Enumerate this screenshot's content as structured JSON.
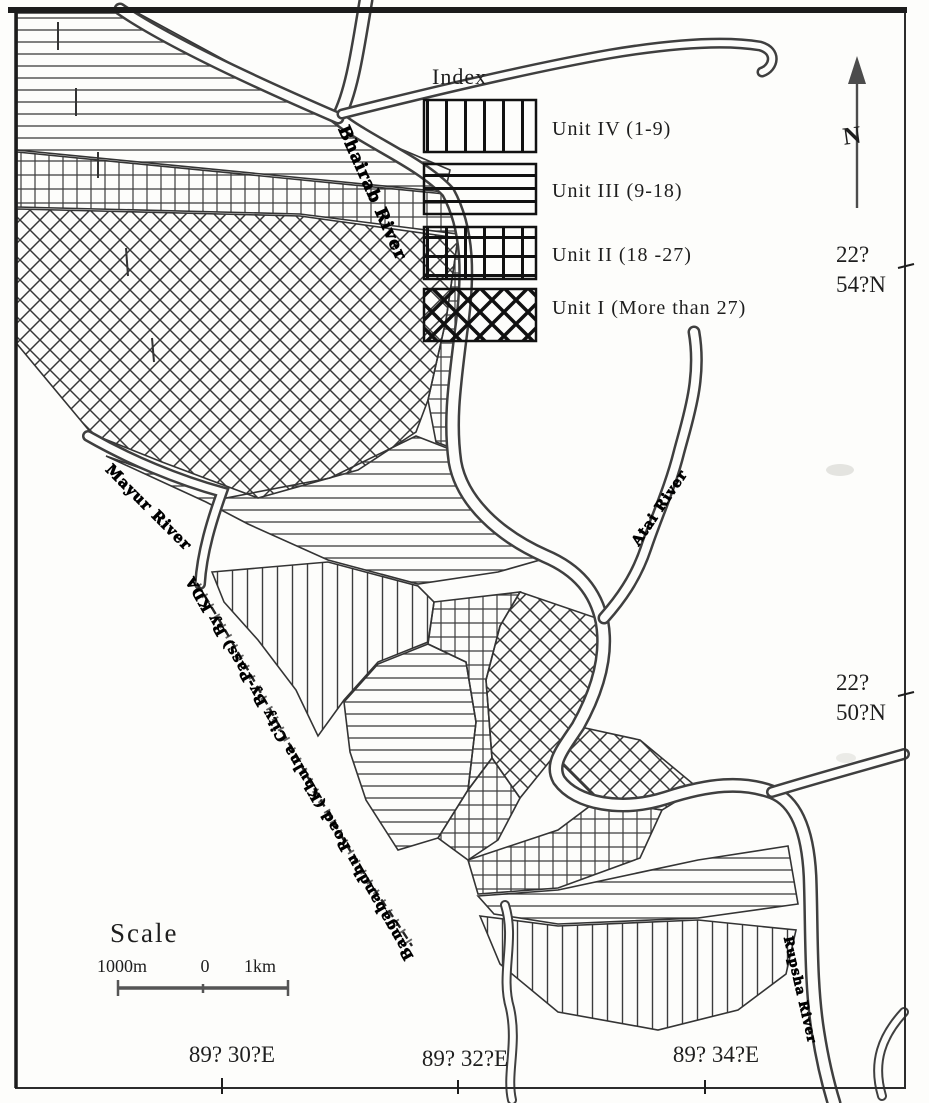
{
  "legend": {
    "title": "Index",
    "items": [
      {
        "label": "Unit IV (1-9)",
        "pattern": "vertical-lines"
      },
      {
        "label": "Unit III (9-18)",
        "pattern": "horizontal-lines"
      },
      {
        "label": "Unit II (18 -27)",
        "pattern": "grid-crosshatch"
      },
      {
        "label": "Unit I (More than 27)",
        "pattern": "diagonal-crosshatch"
      }
    ]
  },
  "rivers": {
    "bhairab": "Bhairab River",
    "mayur": "Mayur River",
    "atai": "Atai River",
    "rupsha": "Rupsha River"
  },
  "road_label": "Bangabandhu Road (Khulna City By-Pass) By KDA",
  "compass": {
    "label": "N"
  },
  "graticule": {
    "right": [
      {
        "deg": "22?",
        "min": "54?N"
      },
      {
        "deg": "22?",
        "min": "50?N"
      }
    ],
    "bottom": [
      "89? 30?E",
      "89? 32?E",
      "89? 34?E"
    ]
  },
  "scale": {
    "title": "Scale",
    "left_label": "1000m",
    "zero_label": "0",
    "right_label": "1km"
  }
}
